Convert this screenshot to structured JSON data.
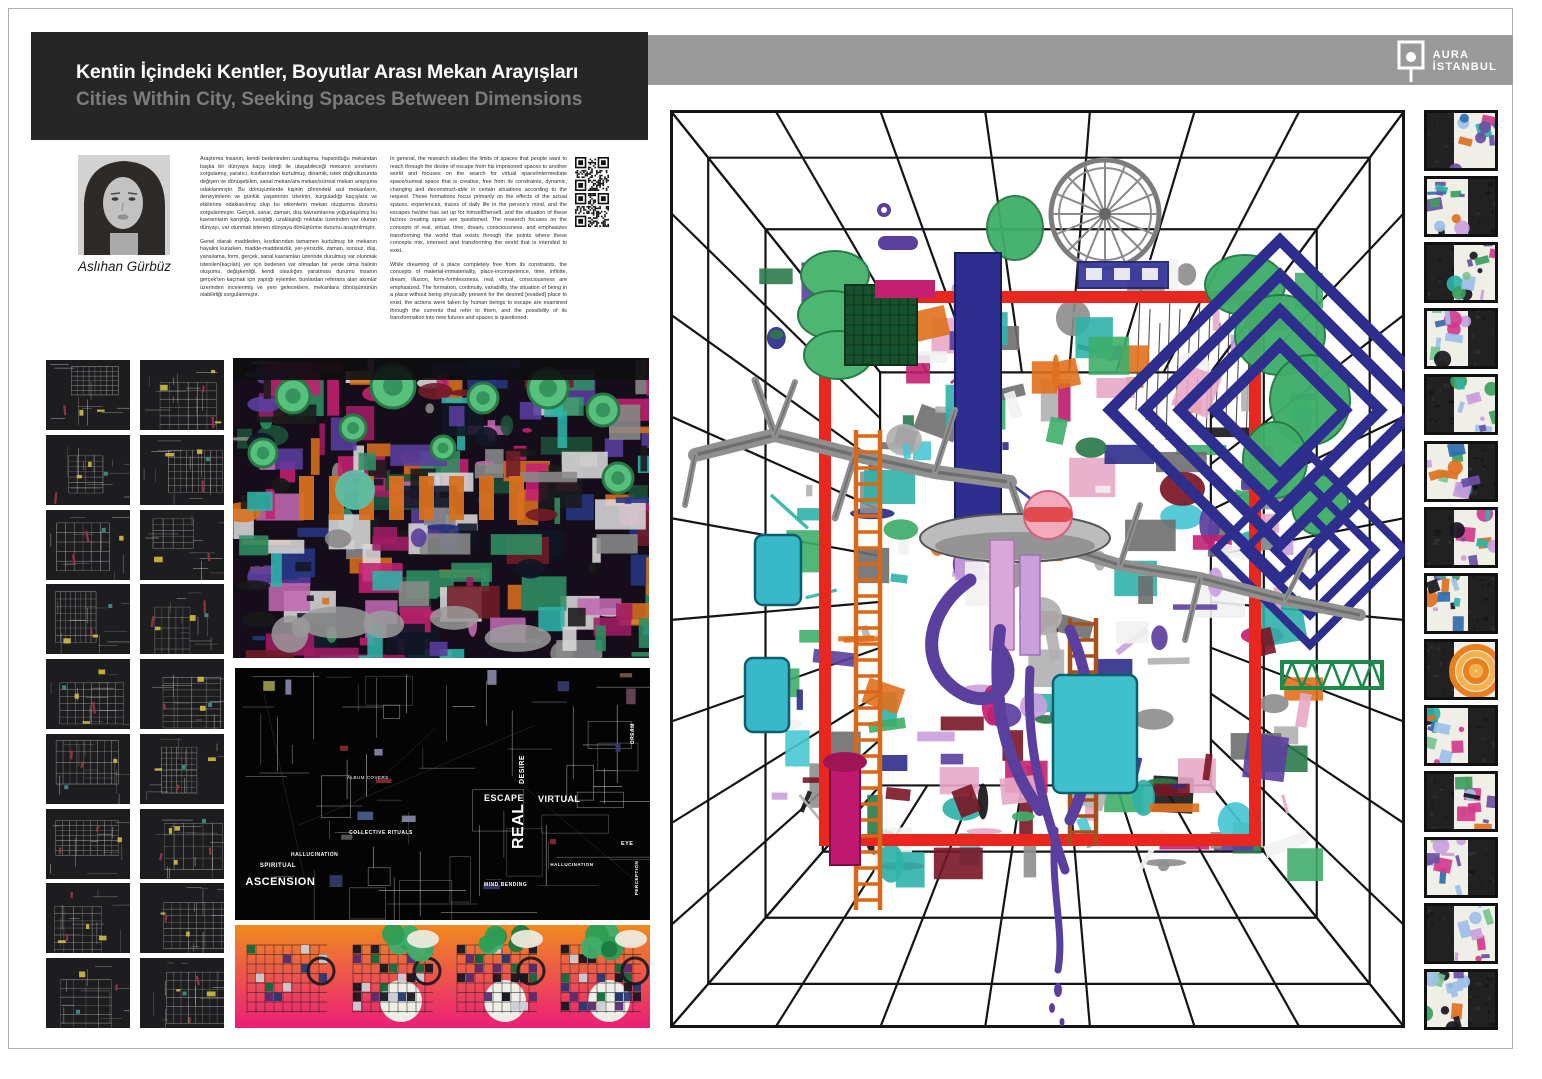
{
  "header": {
    "title_tr": "Kentin İçindeki Kentler, Boyutlar Arası Mekan Arayışları",
    "title_en": "Cities Within City, Seeking Spaces Between Dimensions"
  },
  "brand": {
    "line1": "AURA",
    "line2": "İSTANBUL"
  },
  "author": {
    "name": "Aslıhan Gürbüz"
  },
  "bio_tr": {
    "p1": "Araştırma insanın, kendi bedeninden uzaklaşma, hapsolduğu mekandan başka bir dünyaya kaçış isteği ile ulaşabileceği mekanın sınırlarını sorgulamış, yaratıcı, kısıtlarından kurtulmuş, dinamik, istek doğrultusunda değişen ve dönüşebilen, sanal mekan/ara mekan/sürreal mekan arayışına odaklanmıştır. Bu dönüşümlerde kişinin zihnindeki asıl mekanların, deneyimlerin ve günlük yaşamının izlerinin, kurguladığı kaçışlara ve etkilerine odaklanılmış olup bu etkenlerin mekan oluşturma durumu sorgulanmıştır. Gerçek, sanal, zaman, düş kavramlarına yoğunlaşılmış bu kavramların karıştığı, kesiştiği, uzaklaştığı noktalar üzerinden var olunan dünyayı, var olunmak istenen dünyaya dönüştürme durumu araştırılmıştır.",
    "p2": "Genel olarak maddeden, kısıtlarından tamamen kurtulmuş bir mekanın hayalini kurarken, madde-maddesizlik, yer-yersizlik, zaman, sonsuz, düş, yansılama, form, gerçek, sanal kavramları üzerinde durulmuş var olunmak istenilen(kaçılan) yer için bedenen var olmadan bir yerde olma halinin oluşumu, değişkenliği, kendi olasılığını yaratması durumu insanın gerçek'ten kaçmak için yaptığı eylemler, bunlardan referans alan akımlar üzerinden incelenmiş ve yeni geleceklere, mekanlara dönüşümünün olabilirliği sorgulanmıştır."
  },
  "bio_en": {
    "p1": "In general, the research studies the limits of spaces that people want to reach through the desire of escape from his imprisoned spaces to another world and focuses on the search for virtual space/intermediate space/surreal space that is creative, free from its constraints, dynamic, changing and deconstruct-able in certain situations according to the request. These formations focus primarily on the effects of the actual spaces, experiences, traces of daily life in the person's mind, and the escapes he/she has set up for himself/herself, and the situation of these factors creating space are questioned. The research focuses on the concepts of real, virtual, time, dream, consciousness, and emphasizes transforming the world that exists through the points where these concepts mix, intersect and transforming the world that is intended to exist.",
    "p2": "While dreaming of a place completely free from its constraints, the concepts of material-immateriality, place-incompetence, time, infinite, dream, illusion, form-formlessness, real, virtual, consciousness are emphasized. The formation, continuity, variability, the situation of being in a place without being physically present for the desired [evaded] place to exist, the actions were taken by human beings to escape are examined through the currents that refer to them, and the possibility of its transformation into new futures and spaces is questioned."
  },
  "concept_map": {
    "labels": [
      {
        "text": "ASCENSION",
        "x": 0.025,
        "y": 0.83,
        "size": 11,
        "rot": 0,
        "bold": true
      },
      {
        "text": "SPIRITUAL",
        "x": 0.06,
        "y": 0.775,
        "size": 6,
        "rot": 0,
        "bold": true
      },
      {
        "text": "HALLUCINATION",
        "x": 0.135,
        "y": 0.735,
        "size": 5,
        "rot": 0,
        "bold": true
      },
      {
        "text": "ALBUM COVERS",
        "x": 0.27,
        "y": 0.43,
        "size": 4.5,
        "rot": 0,
        "bold": false
      },
      {
        "text": "COLLECTIVE RITUALS",
        "x": 0.275,
        "y": 0.645,
        "size": 5,
        "rot": 0,
        "bold": true
      },
      {
        "text": "ESCAPE",
        "x": 0.6,
        "y": 0.5,
        "size": 9,
        "rot": 0,
        "bold": true
      },
      {
        "text": "REAL",
        "x": 0.665,
        "y": 0.72,
        "size": 16,
        "rot": -90,
        "bold": true
      },
      {
        "text": "VIRTUAL",
        "x": 0.73,
        "y": 0.505,
        "size": 9,
        "rot": 0,
        "bold": true
      },
      {
        "text": "DESIRE",
        "x": 0.685,
        "y": 0.46,
        "size": 7,
        "rot": -90,
        "bold": true
      },
      {
        "text": "MIND BENDING",
        "x": 0.6,
        "y": 0.855,
        "size": 5,
        "rot": 0,
        "bold": true
      },
      {
        "text": "HALLUCINATION",
        "x": 0.76,
        "y": 0.775,
        "size": 4.5,
        "rot": 0,
        "bold": true
      },
      {
        "text": "DREAM",
        "x": 0.955,
        "y": 0.3,
        "size": 5,
        "rot": -90,
        "bold": true
      },
      {
        "text": "EYE",
        "x": 0.93,
        "y": 0.69,
        "size": 5.5,
        "rot": 0,
        "bold": true
      },
      {
        "text": "PERCEPTION",
        "x": 0.965,
        "y": 0.9,
        "size": 4.5,
        "rot": -90,
        "bold": true
      }
    ]
  },
  "left_grid": {
    "thumbnail_count": 18
  },
  "right_column": {
    "thumbnail_count": 14
  },
  "colors": {
    "header_bg": "#262626",
    "topbar_bg": "#9a9a9a",
    "red_frame": "#e8281e",
    "strip_gradient_top": "#f08a1e",
    "strip_gradient_bottom": "#ec1e78",
    "map_bg": "#040404",
    "cad_thumb_bg": "#1d1d1f"
  }
}
